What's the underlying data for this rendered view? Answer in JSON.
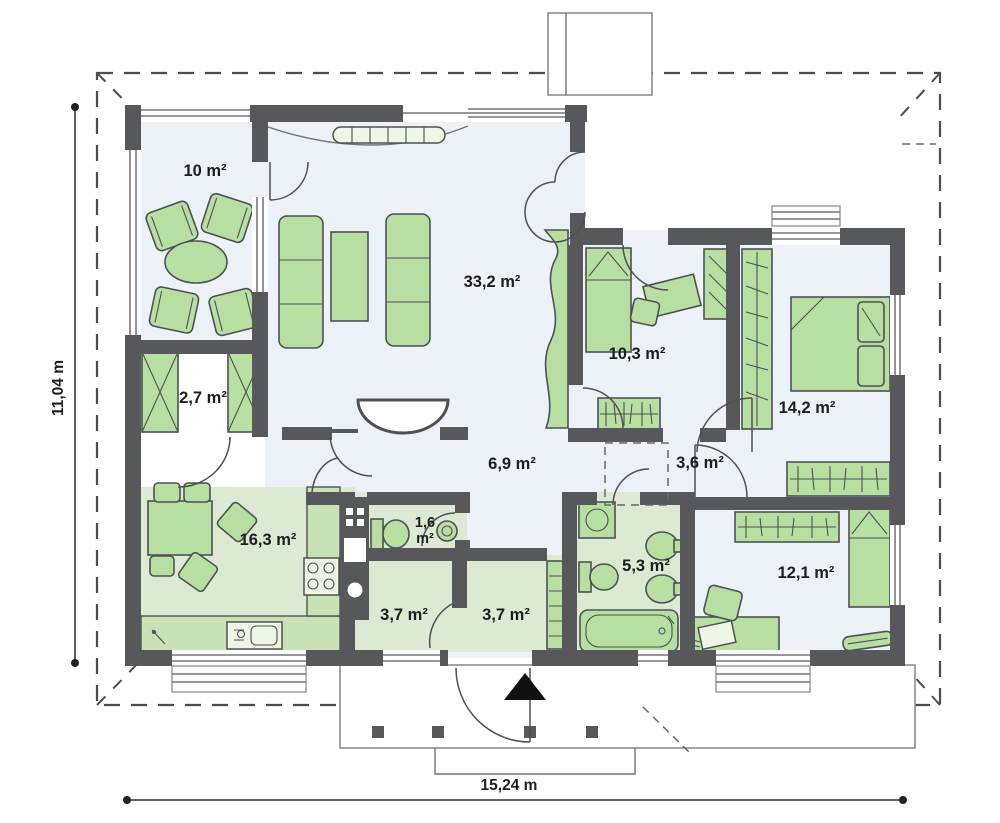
{
  "rooms": {
    "terrace": {
      "area": "10 m²"
    },
    "living_room": {
      "area": "33,2 m²"
    },
    "bedroom_top": {
      "area": "10,3 m²"
    },
    "bedroom_right": {
      "area": "14,2 m²"
    },
    "wardrobe_room": {
      "area": "2,7 m²"
    },
    "hall": {
      "area": "6,9 m²"
    },
    "hall_small": {
      "area": "3,6 m²"
    },
    "kitchen": {
      "area": "16,3 m²"
    },
    "wc": {
      "value": "1,6",
      "unit": "m²"
    },
    "bathroom": {
      "area": "5,3 m²"
    },
    "storage": {
      "area": "3,7 m²"
    },
    "vestibule": {
      "area": "3,7 m²"
    },
    "bedroom_bottom": {
      "area": "12,1 m²"
    }
  },
  "dimensions": {
    "overall_width": "15,24 m",
    "overall_height": "11,04 m"
  },
  "colors": {
    "wall": "#57585c",
    "furniture": "#b7dfa2",
    "furniture_outline": "#4f5054",
    "floor_cool": "#edf1f8",
    "floor_green": "#dcead3",
    "counter": "#c9e2b5",
    "dash": "#4c4d4f",
    "text": "#1d1d1f",
    "background": "#ffffff"
  }
}
